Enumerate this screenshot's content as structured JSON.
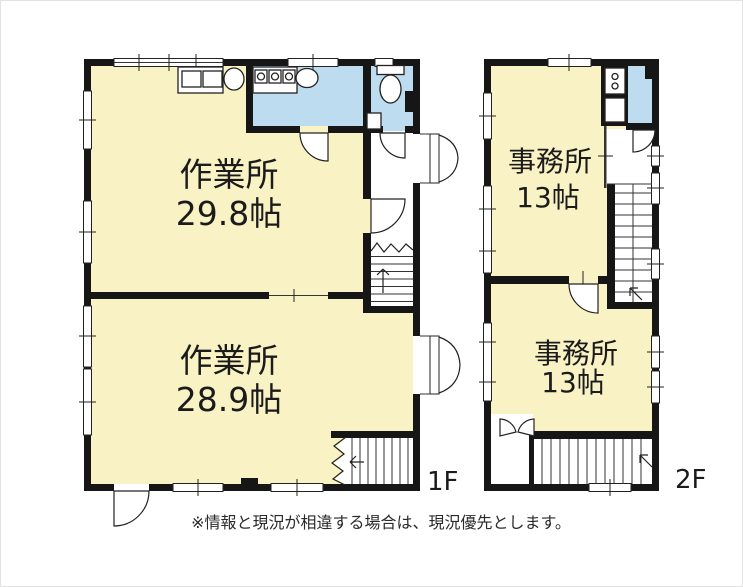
{
  "plans": [
    {
      "floor_label": "1F",
      "rooms": [
        {
          "name": "作業所",
          "size": "29.8帖"
        },
        {
          "name": "作業所",
          "size": "28.9帖"
        }
      ]
    },
    {
      "floor_label": "2F",
      "rooms": [
        {
          "name": "事務所",
          "size": "13帖"
        },
        {
          "name": "事務所",
          "size": "13帖"
        }
      ]
    }
  ],
  "footnote": "※情報と現況が相違する場合は、現況優先とします。",
  "colors": {
    "room_fill": "#f9f2c4",
    "wet_area_fill": "#bedcf0",
    "wall": "#161616",
    "text": "#1b1b1b"
  }
}
